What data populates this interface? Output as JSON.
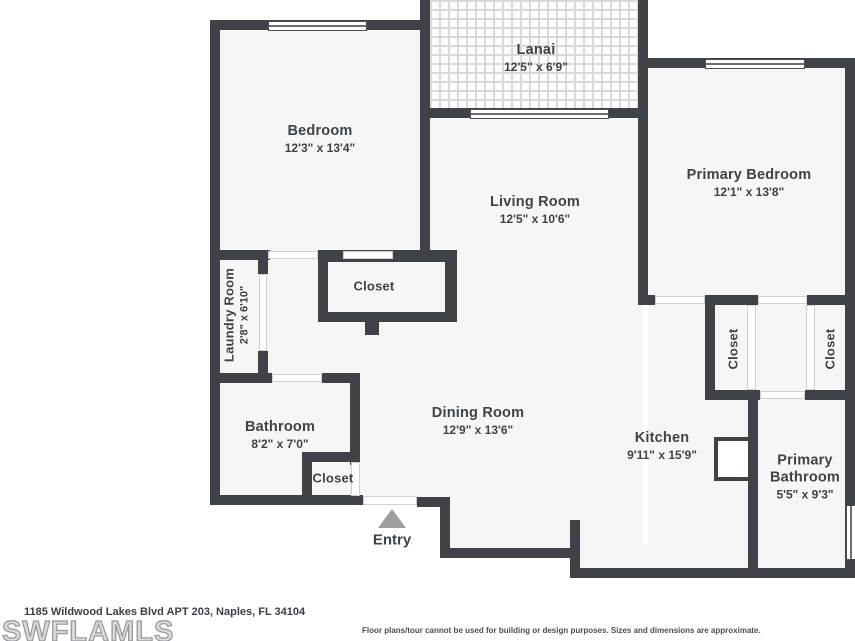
{
  "plan": {
    "rooms": {
      "lanai": {
        "name": "Lanai",
        "dims": "12'5\" x 6'9\""
      },
      "bedroom": {
        "name": "Bedroom",
        "dims": "12'3\" x 13'4\""
      },
      "primary_bedroom": {
        "name": "Primary Bedroom",
        "dims": "12'1\" x 13'8\""
      },
      "living_room": {
        "name": "Living Room",
        "dims": "12'5\" x 10'6\""
      },
      "laundry_room": {
        "name": "Laundry Room",
        "dims": "2'8\" x 6'10\""
      },
      "bedroom_closet": {
        "name": "Closet"
      },
      "bathroom": {
        "name": "Bathroom",
        "dims": "8'2\" x 7'0\""
      },
      "entry_closet": {
        "name": "Closet"
      },
      "dining_room": {
        "name": "Dining Room",
        "dims": "12'9\" x 13'6\""
      },
      "kitchen": {
        "name": "Kitchen",
        "dims": "9'11\" x 15'9\""
      },
      "primary_bathroom": {
        "name": "Primary Bathroom",
        "dims": "5'5\" x 9'3\""
      },
      "closet_left": {
        "name": "Closet"
      },
      "closet_right": {
        "name": "Closet"
      },
      "entry": {
        "name": "Entry"
      }
    }
  },
  "footer": {
    "address": "1185 Wildwood Lakes Blvd APT 203, Naples, FL 34104",
    "logo": "SWFLAMLS",
    "disclaimer": "Floor plans/tour cannot be used for building or design purposes. Sizes and dimensions are approximate."
  },
  "colors": {
    "wall": "#3f4347",
    "floor": "#f6f6f6",
    "text": "#3e4348",
    "arrow": "#9e9e9e"
  }
}
